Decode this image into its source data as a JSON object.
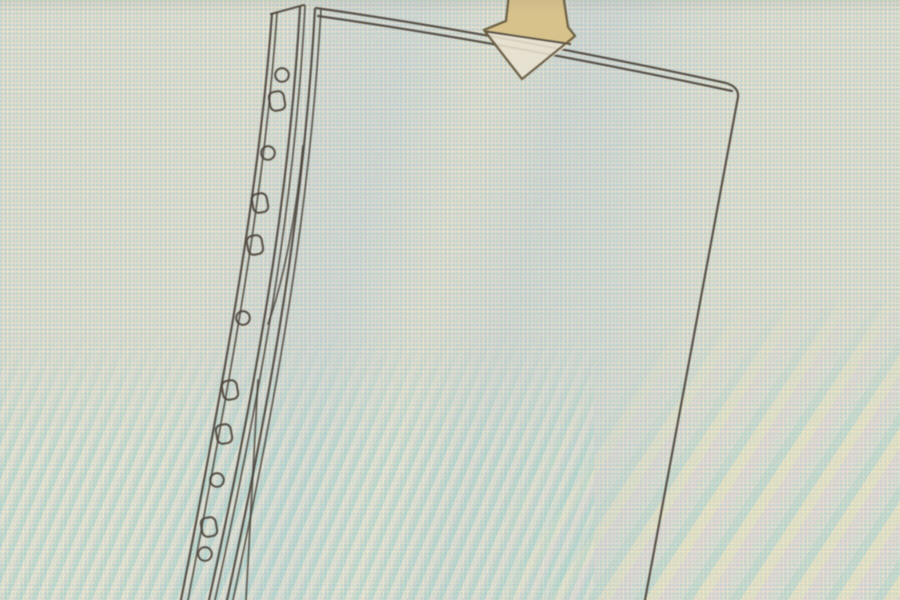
{
  "figure": {
    "aria_label": "Photographed screen showing a line drawing of a transparent multi-punched pocket (sheet protector) with a beige arrow pointing down into the top opening, indicating where a sheet is inserted",
    "hole_count": 11
  },
  "colors": {
    "background": "#ddd9d0",
    "line": "#49423a",
    "arrow_fill": "#d7c28c",
    "arrow_fill_translucent": "#e9e3d0",
    "arrow_outline": "#6a5e41",
    "moire_cyan": "#78c3be",
    "moire_cream": "#f6f0c8",
    "moire_pink": "#e6c8d7",
    "moire_blue": "#96afd7"
  },
  "holes": [
    {
      "shape": "round",
      "x": 282,
      "y": 75
    },
    {
      "shape": "oblong",
      "x": 277,
      "y": 101
    },
    {
      "shape": "round",
      "x": 268,
      "y": 153
    },
    {
      "shape": "oblong",
      "x": 260,
      "y": 203
    },
    {
      "shape": "oblong",
      "x": 255,
      "y": 245
    },
    {
      "shape": "round",
      "x": 243,
      "y": 318
    },
    {
      "shape": "oblong",
      "x": 230,
      "y": 390
    },
    {
      "shape": "oblong",
      "x": 224,
      "y": 434
    },
    {
      "shape": "round",
      "x": 217,
      "y": 480
    },
    {
      "shape": "oblong",
      "x": 209,
      "y": 527
    },
    {
      "shape": "round",
      "x": 205,
      "y": 554
    }
  ]
}
